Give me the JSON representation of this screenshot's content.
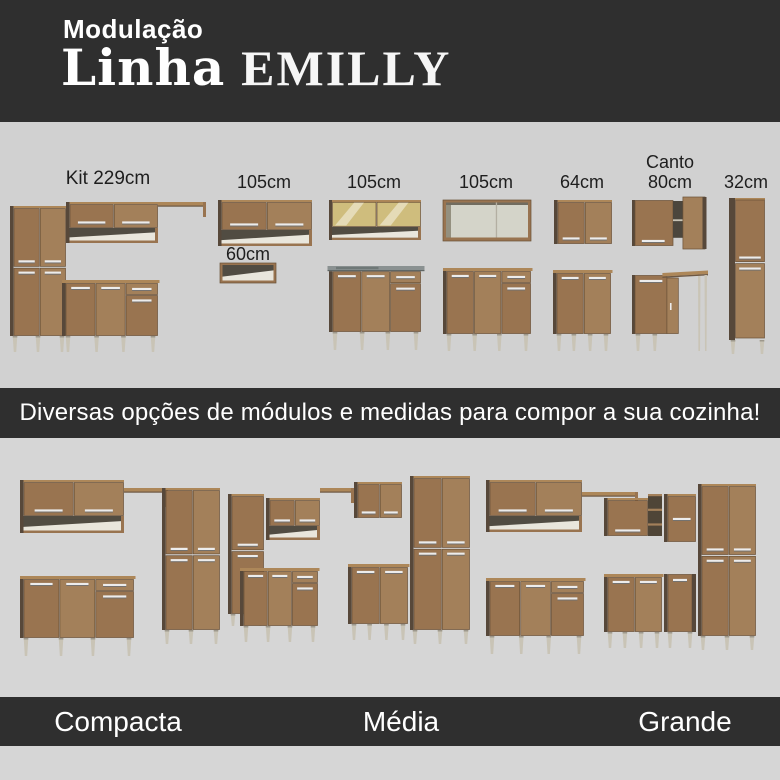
{
  "header": {
    "kicker": "Modulação",
    "title_regular": "Linha",
    "title_emphasis": "EMILLY"
  },
  "modules_section": {
    "modules": [
      {
        "label": "Kit 229cm",
        "name": "kit-229"
      },
      {
        "label": "105cm",
        "name": "wall-cabinet-105"
      },
      {
        "label": "60cm",
        "name": "niche-60"
      },
      {
        "label": "105cm",
        "name": "glass-cabinet-and-sink-base-105"
      },
      {
        "label": "105cm",
        "name": "open-cabinet-and-base-105"
      },
      {
        "label": "64cm",
        "name": "wall-and-base-64"
      },
      {
        "label": "Canto",
        "label2": "80cm",
        "name": "corner-80"
      },
      {
        "label": "32cm",
        "name": "tall-cabinet-32"
      }
    ]
  },
  "banner": {
    "text": "Diversas opções de módulos e medidas para compor a sua cozinha!"
  },
  "kitchens_section": {
    "kitchens": [
      {
        "label": "Compacta"
      },
      {
        "label": "Média"
      },
      {
        "label": "Grande"
      }
    ]
  },
  "colors": {
    "dark_band": "#2f2f2f",
    "modules_bg": "#d1d1d1",
    "kitchens_bg": "#d6d6d6",
    "text_dark": "#1e1e1e",
    "text_light": "#ffffff",
    "wood_front": "#997450",
    "wood_front_alt": "#a3805a",
    "wood_side": "#57483a",
    "wood_edge": "#6a5137",
    "wood_top": "#ad8759",
    "interior_dark": "#514c42",
    "interior_light": "#e9e6dc",
    "open_interior": "#d4d4c9",
    "leg": "#c9c4b6",
    "handle": "#ececec",
    "counter": "#8a9191",
    "glass": "#cfbd7d"
  }
}
